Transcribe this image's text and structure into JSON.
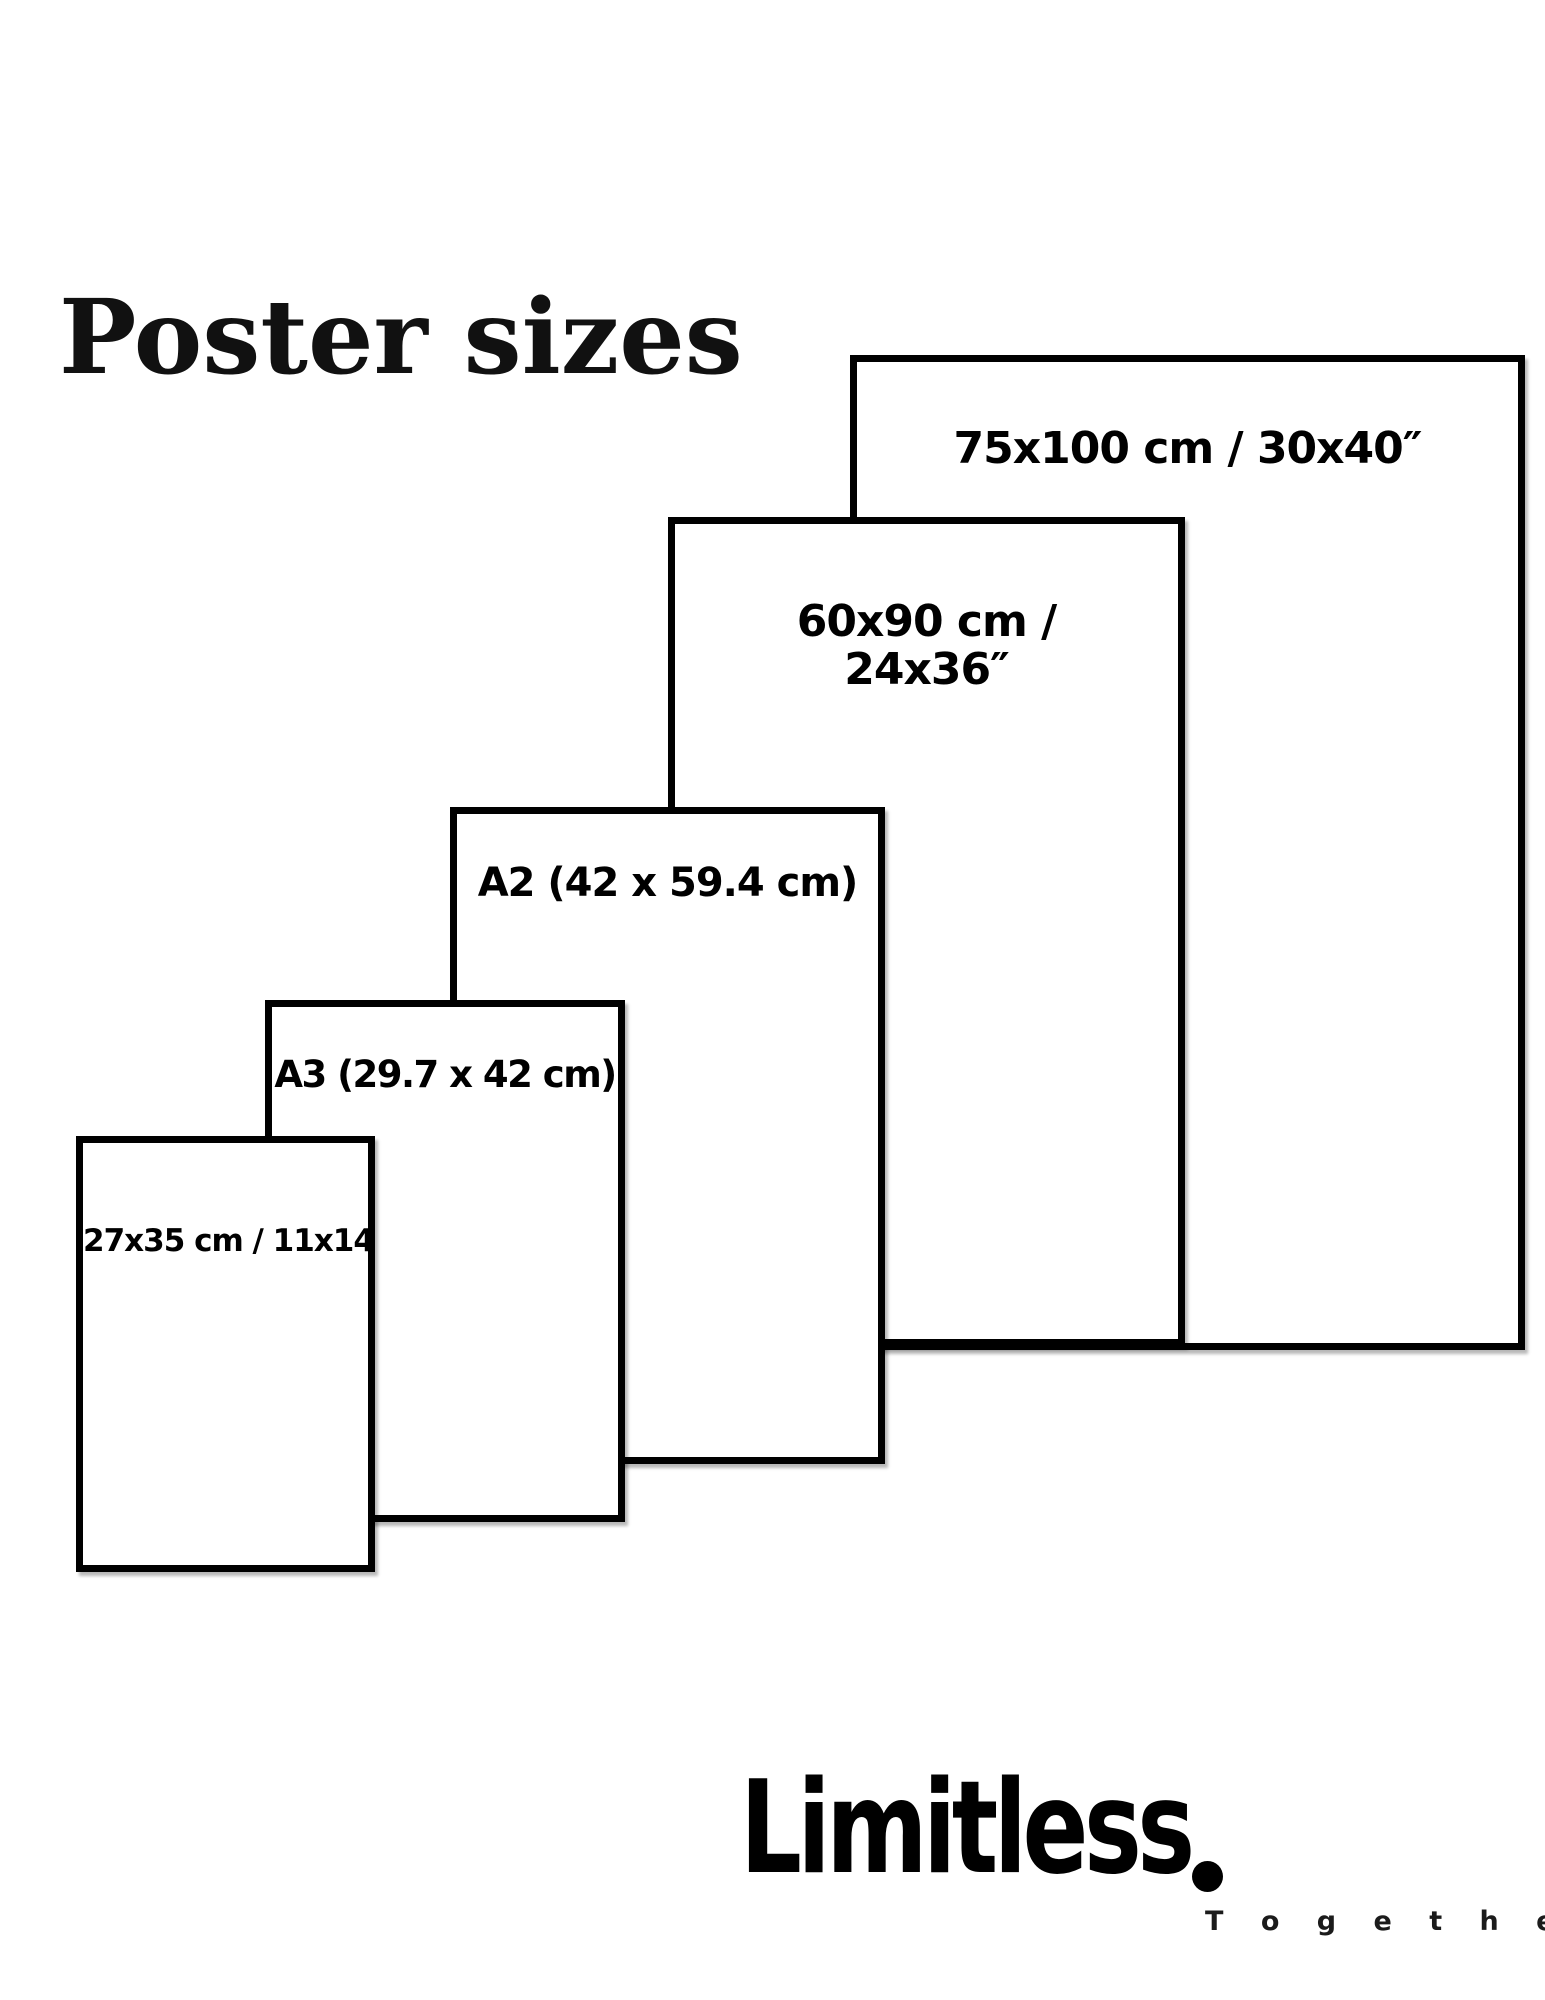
{
  "title": "Poster sizes",
  "posters": [
    {
      "name": "75x100",
      "label": "75x100 cm / 30x40″"
    },
    {
      "name": "60x90",
      "label_line1": "60x90 cm /",
      "label_line2": "24x36″"
    },
    {
      "name": "A2",
      "label": "A2 (42 x 59.4 cm)"
    },
    {
      "name": "A3",
      "label": "A3 (29.7 x 42 cm)"
    },
    {
      "name": "27x35",
      "label": "27x35 cm / 11x14"
    }
  ],
  "brand": {
    "name": "Limitless",
    "period": ".",
    "tagline": "T o g e t h e r"
  },
  "colors": {
    "ink": "#000000",
    "background": "#ffffff"
  }
}
